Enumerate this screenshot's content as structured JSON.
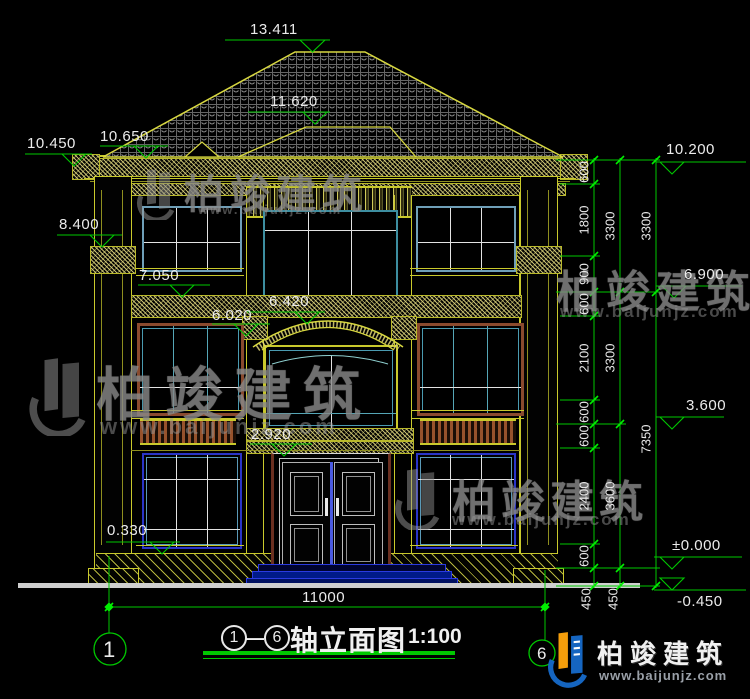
{
  "title_block": {
    "axis_start": "1",
    "axis_end": "6",
    "separator": "—",
    "name": "轴立面图",
    "scale": "1:100"
  },
  "axis_bubbles": {
    "left": "1",
    "right": "6"
  },
  "overall_dim": {
    "width": "11000"
  },
  "elevations": {
    "left": {
      "ridge": "13.411",
      "porch_ridge": "11.620",
      "eave_high": "10.650",
      "eave": "10.450",
      "capital": "8.400",
      "f3_sill": "7.050",
      "arch_top": "6.420",
      "arch_spring": "6.020",
      "door_head": "2.920",
      "plinth": "0.330"
    },
    "right": {
      "eave": "10.200",
      "f3": "6.900",
      "f2": "3.600",
      "zero": "±0.000",
      "ground": "-0.450"
    }
  },
  "dim_chains": {
    "inner": [
      "600",
      "1800",
      "900",
      "600",
      "2100",
      "600",
      "600",
      "2400",
      "600",
      "450"
    ],
    "middle": [
      "3300",
      "3300",
      "3600",
      "450"
    ],
    "outer": [
      "3300",
      "7350"
    ]
  },
  "watermark": {
    "brand": "柏竣建筑",
    "url": "www.baijunjz.com"
  },
  "brand_logo": {
    "name": "柏竣建筑",
    "url": "www.baijunjz.com"
  }
}
